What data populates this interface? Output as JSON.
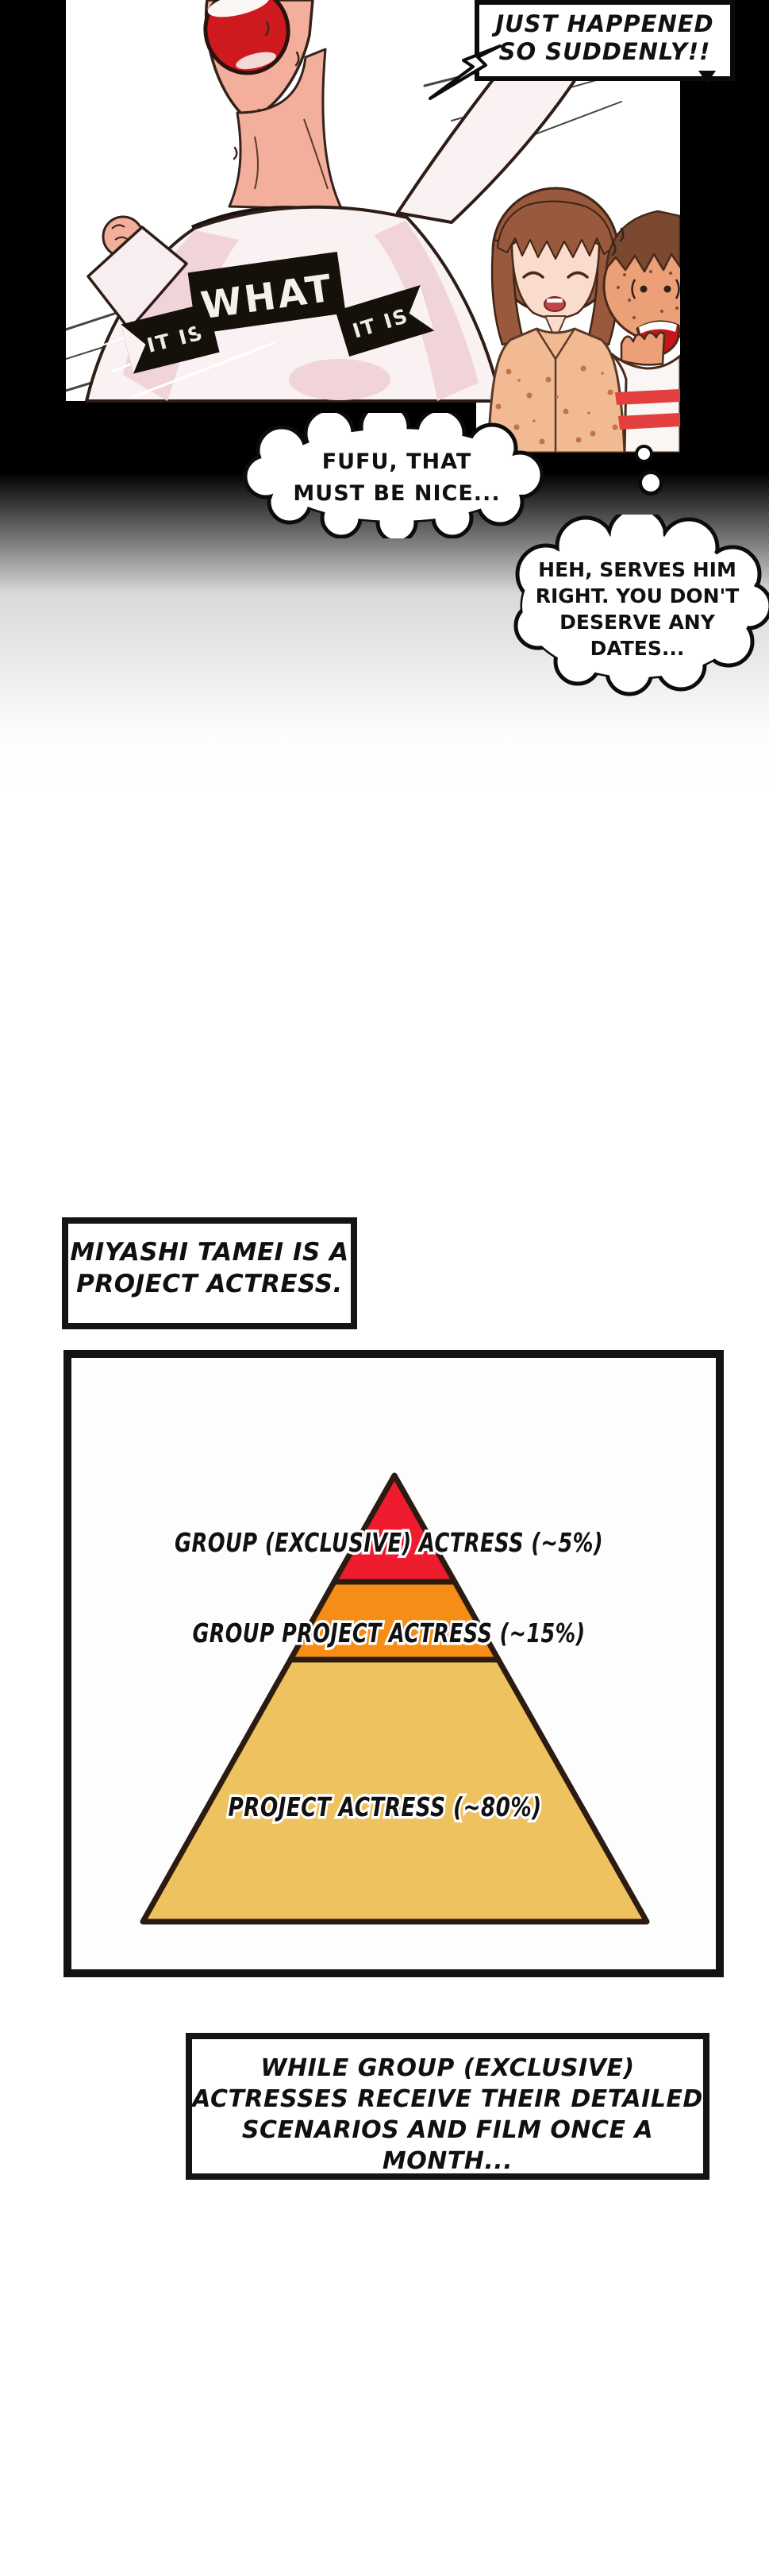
{
  "art_panel": {
    "speech_box": {
      "line1": "JUST HAPPENED",
      "line2": "SO SUDDENLY!!"
    },
    "shirt_banner": {
      "left": "IT IS",
      "center": "WHAT",
      "right": "IT IS"
    },
    "fufu_bubble": {
      "line1": "FUFU, THAT",
      "line2": "MUST BE NICE..."
    },
    "thought_bubble": {
      "line1": "HEH, SERVES HIM",
      "line2": "RIGHT. YOU DON'T",
      "line3": "DESERVE ANY",
      "line4": "DATES..."
    }
  },
  "caption_miyashi": {
    "line1": "MIYASHI TAMEI IS A",
    "line2": "PROJECT ACTRESS."
  },
  "pyramid_panel": {
    "levels": [
      {
        "label": "GROUP (EXCLUSIVE) ACTRESS (~5%)",
        "color": "#ee1c2e"
      },
      {
        "label": "GROUP PROJECT ACTRESS (~15%)",
        "color": "#f68d16"
      },
      {
        "label": "PROJECT ACTRESS (~80%)",
        "color": "#eec25e"
      }
    ],
    "outline_color": "#2b1b10"
  },
  "caption_while": {
    "line1": "WHILE GROUP (EXCLUSIVE)",
    "line2": "ACTRESSES RECEIVE THEIR DETAILED",
    "line3": "SCENARIOS AND FILM ONCE A MONTH..."
  },
  "chart_data": {
    "type": "pyramid",
    "categories": [
      "GROUP (EXCLUSIVE) ACTRESS",
      "GROUP PROJECT ACTRESS",
      "PROJECT ACTRESS"
    ],
    "values": [
      5,
      15,
      80
    ],
    "value_prefix": "~",
    "unit": "%",
    "colors": [
      "#ee1c2e",
      "#f68d16",
      "#eec25e"
    ],
    "title": "",
    "legend": "labels drawn across pyramid levels with white halo"
  }
}
